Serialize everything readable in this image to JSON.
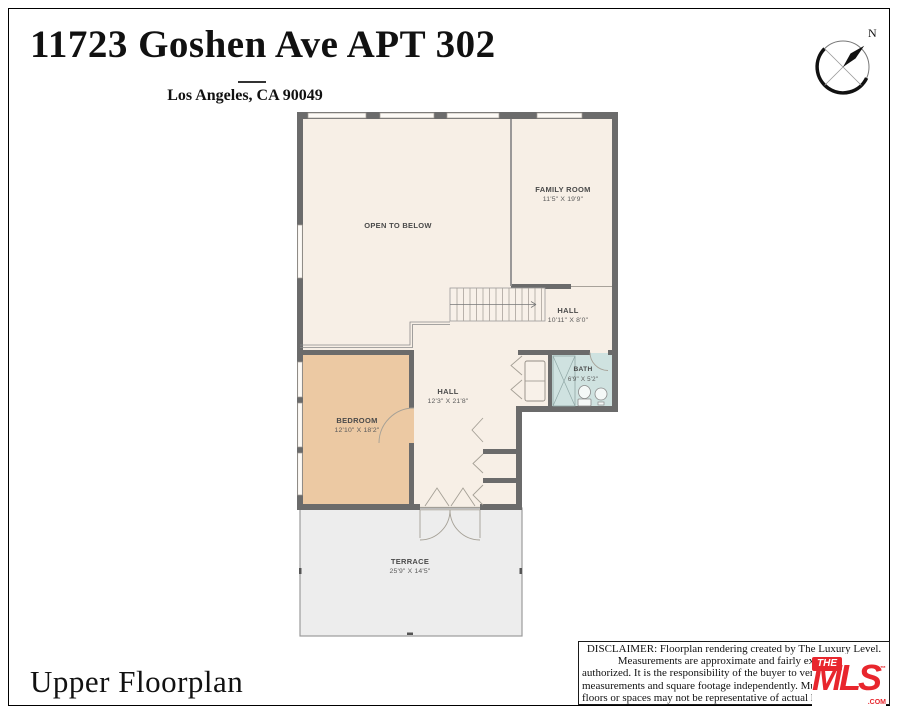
{
  "page": {
    "title": "11723 Goshen Ave APT 302",
    "subtitle": "Los Angeles, CA 90049",
    "footer_title": "Upper Floorplan",
    "compass_label": "N"
  },
  "rooms": [
    {
      "name": "OPEN TO BELOW",
      "dims": ""
    },
    {
      "name": "FAMILY ROOM",
      "dims": "11'5\" X 19'9\""
    },
    {
      "name": "HALL",
      "dims": "10'11\" X 8'0\""
    },
    {
      "name": "HALL",
      "dims": "12'3\" X 21'8\""
    },
    {
      "name": "BEDROOM",
      "dims": "12'10\" X 18'2\""
    },
    {
      "name": "BATH",
      "dims": "6'9\" X 5'2\""
    },
    {
      "name": "TERRACE",
      "dims": "25'9\" X 14'5\""
    }
  ],
  "colors": {
    "floor": "#f7efe6",
    "bedroom": "#ecc9a3",
    "bath": "#cfe2e0",
    "terrace": "#ededed",
    "wall": "#6b6b6b",
    "brand_red": "#e8262d"
  },
  "disclaimer": {
    "lines": [
      "DISCLAIMER: Floorplan rendering created by The Luxury Level.",
      "Measurements are approximate and fairly exact but r",
      "authorized. It is the responsibility of the buyer to verify th",
      "measurements and square footage independently. Multipl",
      "floors or spaces may not be representative of actual locati"
    ]
  },
  "logo": {
    "the": "THE",
    "mls": "MLS",
    "tm": "™",
    "com": ".COM"
  }
}
